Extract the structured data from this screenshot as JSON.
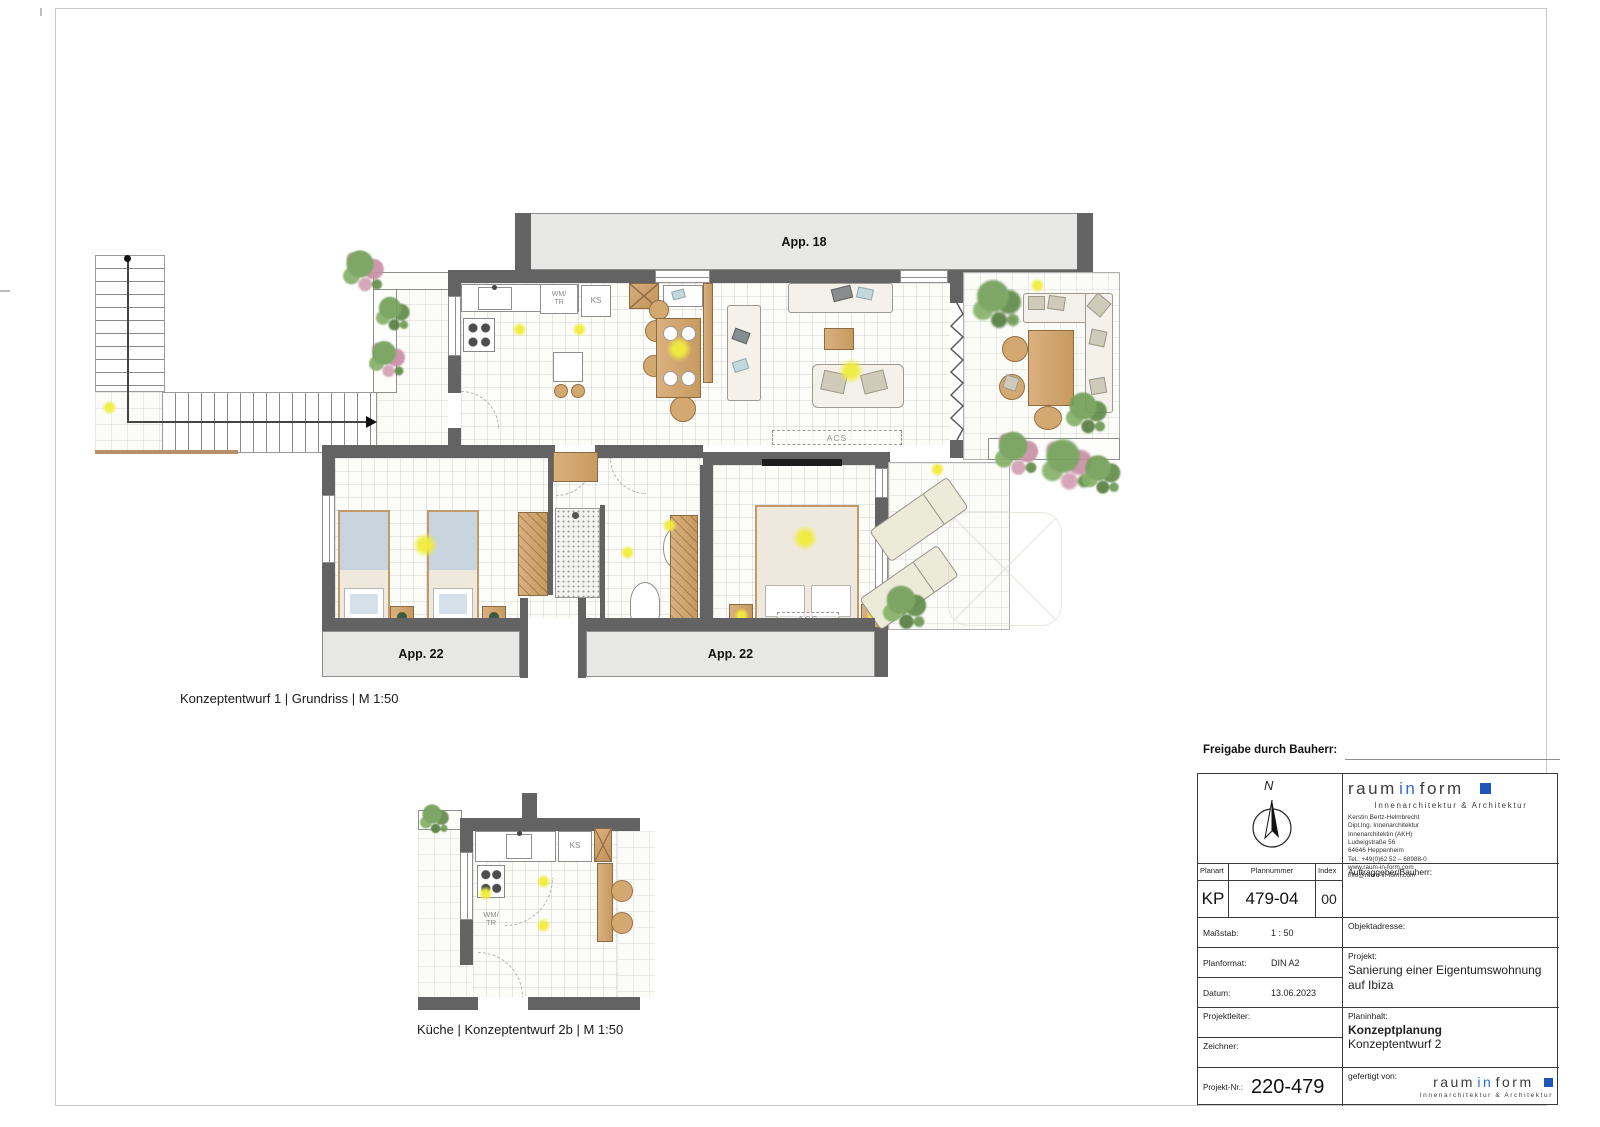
{
  "sheet": {
    "captions": {
      "plan1": "Konzeptentwurf 1 | Grundriss | M 1:50",
      "plan2": "Küche | Konzeptentwurf 2b | M 1:50"
    },
    "approval_label": "Freigabe durch Bauherr:"
  },
  "floorplan": {
    "neighbor_top_label": "App. 18",
    "neighbor_bottom_left_label": "App. 22",
    "neighbor_bottom_right_label": "App. 22",
    "kitchen": {
      "washer_line1": "WM/",
      "washer_line2": "TR",
      "fridge": "KS"
    },
    "acs_living": "ACS",
    "acs_bedroom": "ACS"
  },
  "kitchen_plan": {
    "washer_line1": "WM/",
    "washer_line2": "TR",
    "fridge": "KS"
  },
  "titleblock": {
    "north_label": "N",
    "logo": {
      "word1": "raum",
      "word2": "in",
      "word3": "form",
      "subtitle": "Innenarchitektur & Architektur"
    },
    "address_lines": [
      "Kerstin Bertz-Helmbrecht",
      "Dipl.Ing. Innenarchitektur",
      "Innenarchitektin (AKH)",
      "Ludwigstraße 56",
      "64646 Heppenheim",
      "Tel.: +49(0)62 52 – 68988-0",
      "www.raum-in-form.com",
      "info@raum-in-form.com"
    ],
    "planart_label": "Planart",
    "planart_value": "KP",
    "plannummer_label": "Plannummer",
    "plannummer_value": "479-04",
    "index_label": "Index",
    "index_value": "00",
    "auftraggeber_label": "Auftraggeber/Bauherr:",
    "massstab_label": "Maßstab:",
    "massstab_value": "1 : 50",
    "objektadresse_label": "Objektadresse:",
    "planformat_label": "Planformat:",
    "planformat_value": "DIN A2",
    "projekt_label": "Projekt:",
    "projekt_value": "Sanierung einer Eigentumswohnung auf Ibiza",
    "datum_label": "Datum:",
    "datum_value": "13.06.2023",
    "projektleiter_label": "Projektleiter:",
    "planinhalt_label": "Planinhalt:",
    "planinhalt_value_bold": "Konzeptplanung",
    "planinhalt_value": "Konzeptentwurf 2",
    "zeichner_label": "Zeichner:",
    "projektnr_label": "Projekt-Nr.:",
    "projektnr_value": "220-479",
    "gefertigt_label": "gefertigt von:"
  },
  "colors": {
    "brand_blue": "#2e6bd0",
    "brand_blue_dark": "#1d55b8",
    "wall_gray": "#636363",
    "highlight_yellow": "#f4f04a",
    "neighbor_gray": "#e7e7e5"
  }
}
